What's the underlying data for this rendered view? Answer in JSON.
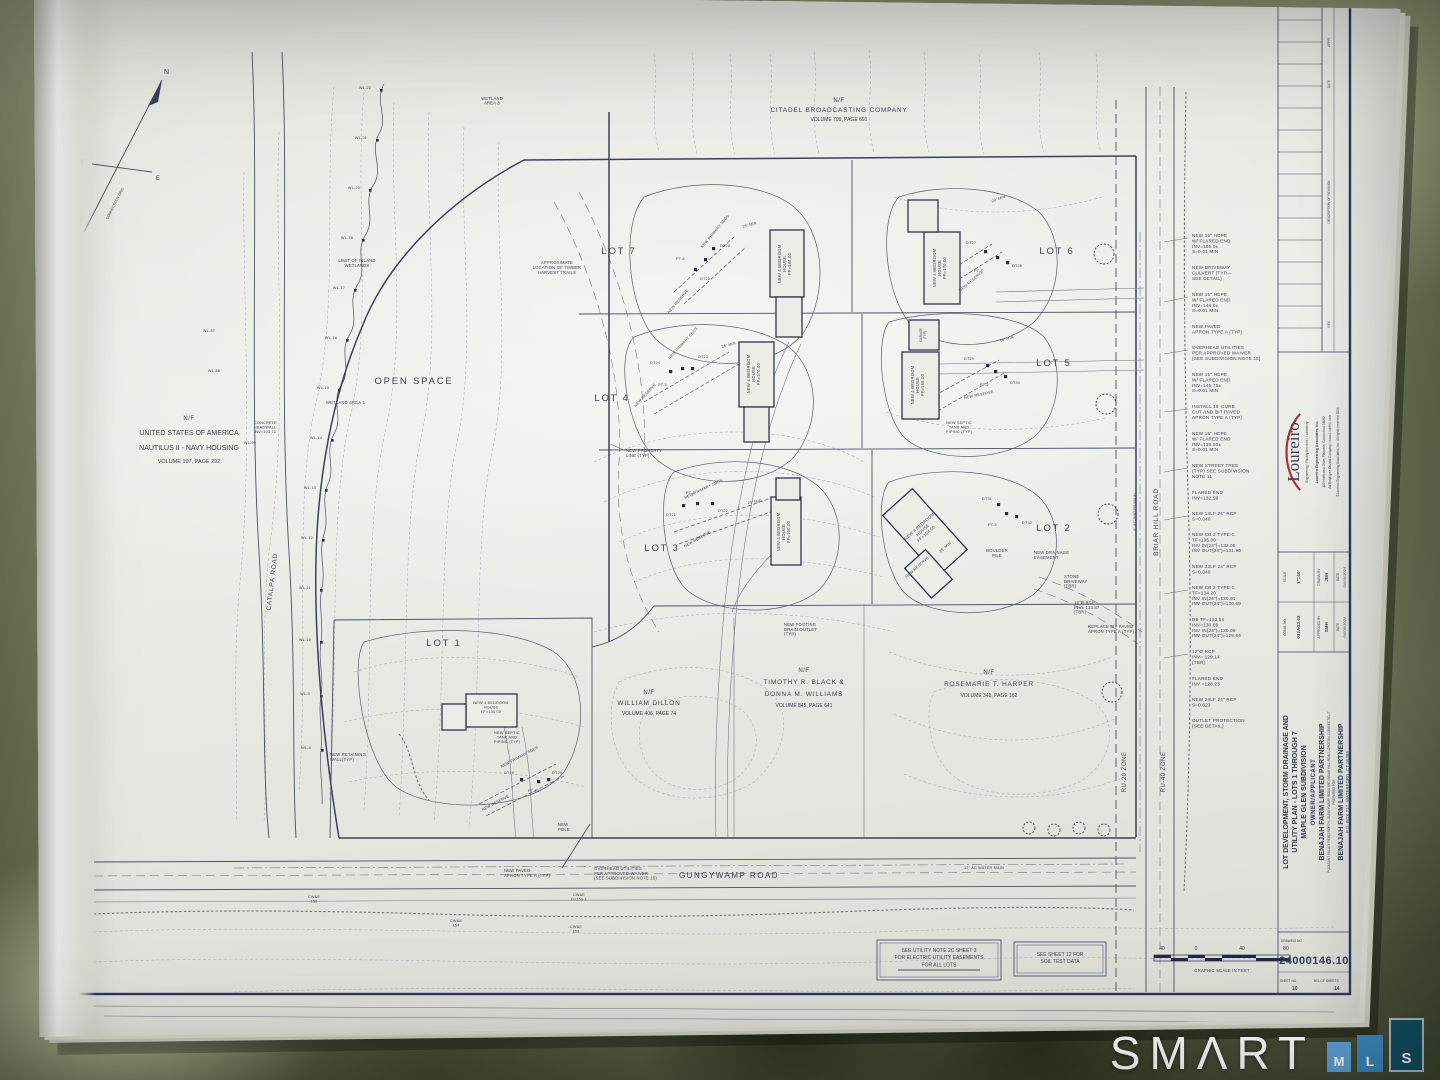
{
  "watermark": {
    "brand": "SMΛRT",
    "mls": [
      "M",
      "L",
      "S"
    ]
  },
  "titleblock": {
    "revision_headers": [
      "APPR.",
      "DATE",
      "DESCRIPTION OF REVISION",
      "REV."
    ],
    "firm": {
      "logo": "Loureiro",
      "tagline": "Engineering • Facility Services • Laboratory",
      "line1": "Loureiro Engineering Associates, Inc.",
      "line2": "100 Northwest Drive, Plainville, Connecticut 06062",
      "line3": "An Employee Owned Company • www.Loureiro.com",
      "line4": "©Loureiro Engineering Associates, Inc. All rights reserved 2024"
    },
    "fields": {
      "scale_label": "SCALE",
      "scale": "1\"=40'",
      "comm_label": "COMM. NO.",
      "comm": "032AG3.02",
      "drawn_label": "DRAWN BY",
      "drawn": "JBH",
      "approved_label": "APPROVED BY",
      "approved": "SMH",
      "date_label": "DATE",
      "date_drawn": "04/05/2024",
      "date_approved": "04/05/2024"
    },
    "project": {
      "title1": "LOT DEVELOPMENT, STORM DRAINAGE AND",
      "title2": "UTILITY PLAN - LOTS 1 THROUGH 7",
      "subdivision": "MAPLE GLEN SUBDIVISION",
      "owner_label": "OWNER/APPLICANT",
      "owner": "BENAJAH FARM LIMITED PARTNERSHIP",
      "location": "PLEASANT VALLEY ROAD NORTH, GUNGYWAMP ROAD AND BRIAR HILL ROAD, GROTON, CONNECTICUT",
      "prepared_label": "PREPARED FOR",
      "client": "BENAJAH FARM LIMITED PARTNERSHIP",
      "client_address": "P.O. BOX 717, WATERFORD, CT 06385"
    },
    "drawing": {
      "label": "DRAWING NO.",
      "number": "24000146.10",
      "sheet_label": "SHEET NO.",
      "sheet": "10",
      "sheets_label": "NO. OF SHEETS",
      "sheets": "14"
    }
  },
  "plan": {
    "compass": {
      "n": "N",
      "s": "S",
      "e": "E",
      "w": "W",
      "grid": "CONNECTICUT GRID"
    },
    "abutters": {
      "citadel": {
        "nf": "N/F",
        "name": "CITADEL BROADCASTING COMPANY",
        "ref": "VOLUME 709, PAGE 691"
      },
      "usa": {
        "nf": "N/F",
        "l1": "UNITED STATES OF AMERICA",
        "l2": "NAUTILUS II - NAVY HOUSING",
        "ref": "VOLUME 197, PAGE 292"
      },
      "dillon": {
        "nf": "N/F",
        "name": "WILLIAM DILLON",
        "ref": "VOLUME 406, PAGE 74"
      },
      "black": {
        "nf": "N/F",
        "l1": "TIMOTHY R. BLACK &",
        "l2": "DONNA M. WILLIAMS",
        "ref": "VOLUME 845, PAGE 641"
      },
      "harper": {
        "nf": "N/F",
        "name": "ROSEMARIE T. HARPER",
        "ref": "VOLUME 345, PAGE 162"
      }
    },
    "lots": {
      "lot1": "LOT 1",
      "lot2": "LOT 2",
      "lot3": "LOT 3",
      "lot4": "LOT 4",
      "lot5": "LOT 5",
      "lot6": "LOT 6",
      "lot7": "LOT 7"
    },
    "open_space": "OPEN SPACE",
    "roads": {
      "catalpa": "CATALPA ROAD",
      "gungywamp": "GUNGYWAMP ROAD",
      "briar": "BRIAR HILL ROAD"
    },
    "zones": {
      "ru20": "RU-20 ZONE",
      "ru40": "RU-40 ZONE"
    },
    "houses": {
      "lot7": "NEW 4 BEDROOM\nHOUSE\nFF=184.00",
      "lot6": "NEW 4 BEDROOM\nHOUSE\nFF=170.00",
      "lot4": "NEW 4 BEDROOM\nHOUSE\nFF=170.00",
      "lot5": "NEW 4 BEDROOM\nHOUSE\nFF=166.00",
      "lot3": "NEW 4 BEDROOM\nHOUSE\nFF=160.00",
      "lot2": "NEW 4 BEDROOM\nHOUSE\nFF=154.00",
      "lot1": "NEW 4 BEDROOM\nHOUSE\nFF=130.00",
      "garage": "GARAGE\n(TYP)"
    },
    "site_labels": {
      "limit_wetlands": "LIMIT OF INLAND\nWETLANDS",
      "wetland_area1": "WETLAND AREA 1",
      "wetland_area3": "WETLAND\nAREA 3",
      "timber": "APPROXIMATE\nLOCATION OF TIMBER\nHARVEST TRAILS",
      "septic": "NEW SEPTIC\nTANK AND\nPIPING (TYP)",
      "property_line": "NEW PROPERTY\nLINE (TYP)",
      "footing": "NEW FOOTING\nDRAIN OUTLET\n(TYP)",
      "retaining": "NEW RETAINING\nWALL(TYP)",
      "pole": "NEW\nPOLE",
      "headwall": "CONCRETE\nHEADWALL\nINV=103.71",
      "boulder": "BOULDER\nPILE",
      "drain_easement": "NEW DRAINAGE\nEASEMENT",
      "stone_drive": "STONE\nDRIVEWAY\n(TBR)",
      "replace_apron": "REPLACE BIT PAVED\nAPRON TYPE A (TYP)",
      "rcp_tbr": "12\"Ø RCP\nINV± 133.87\n(TBR)",
      "water12": "12\" AC WATER MAIN",
      "water8": "8\" AC WATER MAIN",
      "apron": "NEW PAVED\nAPRON TYPE A (TYP)",
      "overhead": "OVERHEAD UTILITIES\nPER APPROVED WAIVER\n(SEE SUBDIVISION NOTE 15)",
      "reserve": "NEW RESERVE",
      "primary": "NEW PRIMARY SDDS",
      "min25": "25' MIN",
      "min20": "20' MIN",
      "min10": "10' MIN"
    },
    "cwe": [
      "CW&E\n155",
      "CW&E\n154",
      "CW&E\nD=153-1",
      "CW&E\n153"
    ],
    "testpits": {
      "lot7": [
        "DT25",
        "DT26",
        "PT-6"
      ],
      "lot6": [
        "DT27",
        "DT28",
        "PT-7"
      ],
      "lot4": [
        "DT24",
        "DT23",
        "PT-5"
      ],
      "lot5": [
        "DT29",
        "DT30",
        "PT-2"
      ],
      "lot3": [
        "DT21",
        "DT22",
        "PT-1"
      ],
      "lot2": [
        "DT31",
        "DT32",
        "PT-3"
      ],
      "lot1": [
        "DT19",
        "DT20",
        "PT-13"
      ]
    },
    "wl_flags": [
      "WL-22",
      "WL-21",
      "WL-20",
      "WL-18",
      "WL-17",
      "WL-16",
      "WL-15",
      "WL-14",
      "WL-13",
      "WL-12",
      "WL-11",
      "WL-10",
      "WL-9",
      "WL-8",
      "WL-86",
      "WL-87",
      "WL-90"
    ],
    "callouts": [
      "NEW 15\" HDPE\nW/ FLARED END\nINV=150.0±\nS=0.01 MIN",
      "NEW DRIVEWAY\nCULVERT (TYP—\nSEE DETAIL)",
      "NEW 15\" HDPE\nW/ FLARED END\nINV=146.0±\nS=0.01 MIN",
      "NEW PAVED\nAPRON TYPE A (TYP)",
      "OVERHEAD UTILITIES\nPER APPROVED WAIVER\n(SEE SUBDIVISION NOTE 15)",
      "NEW 15\" HDPE\nW/ FLARED END\nINV=145.75±\nS=0.01 MIN",
      "INSTALL 18' CURB\nCUT AND BIT PAVED\nAPRON TYPE A (TYP)",
      "NEW 15\" HDPE\nW/ FLARED END\nINV=139.50±\nS=0.01 MIN",
      "NEW STREET TREE\n(TYP) SEE SUBDIVISION\nNOTE 11",
      "FLARED END\nINV=132.59",
      "NEW 14LF 24\" RCP\nS=0.040",
      "NEW CB 2 TYPE C\nTF=135.00\nINV IN(24\")=132.05\nINV OUT(24\")=131.90",
      "NEW 33LF 24\" RCP\nS=0.040",
      "NEW CB 2 TYPE C\nTF=134.20\nINV IN(24\")=130.91\nINV OUT(24\")=130.69",
      "DB  TF=133.54\nINV=130.89\nINV IN(24\")=130.09\nINV OUT(24\")=129.64",
      "12\"Ø RCP\nINV= 129.14\n(TBR)",
      "FLARED END\nINV =128.23",
      "NEW 24LF 24\" RCP\nS=0.023",
      "OUTLET PROTECTION\n(SEE DETAIL)"
    ],
    "notes": {
      "note1": "SEE UTILITY NOTE 2C SHEET 2\nFOR ELECTRIC UTILITY EASEMENTS\nFOR ALL LOTS",
      "note2": "SEE SHEET 12 FOR\nSOIL TEST DATA"
    },
    "scalebar": {
      "t1": "40",
      "t2": "0",
      "t3": "40",
      "t4": "80",
      "caption": "GRAPHIC SCALE IN FEET"
    }
  }
}
